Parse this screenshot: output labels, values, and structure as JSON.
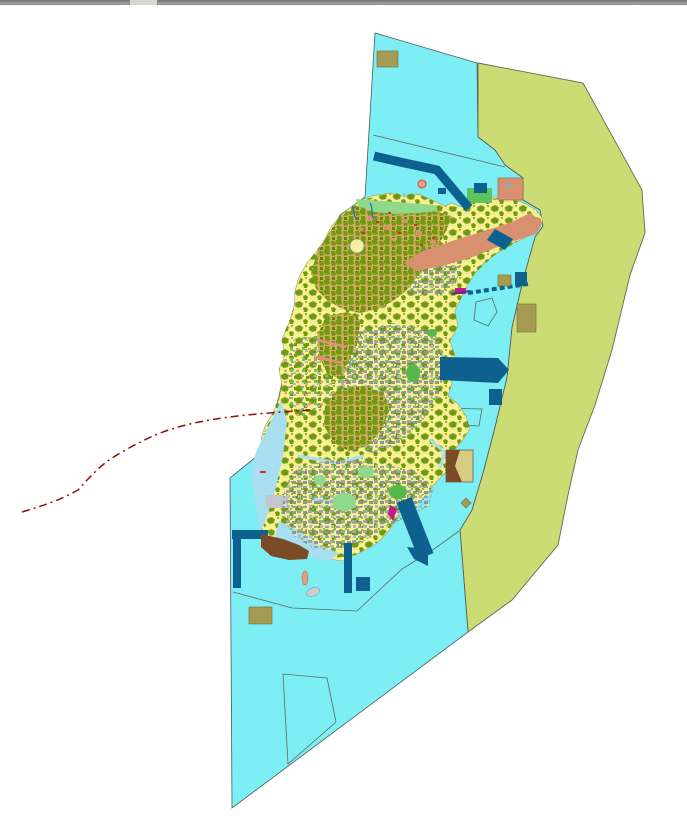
{
  "window": {
    "top_bar": {
      "color": "#8a8a8a",
      "handle_color": "#d9d6ce"
    }
  },
  "map": {
    "background": "#ffffff",
    "colors": {
      "sea": "#7deef4",
      "outer_zone": "#ccdc74",
      "island": "#f8f290",
      "forest": "#6e9a0f",
      "forest_dense_bg": "#cfa95e",
      "urban": "#a0a3ab",
      "grass": "#55b94a",
      "grass_light": "#8fd98c",
      "wetland": "#a8dff0",
      "harbour_zone": "#d79171",
      "port_works": "#0e608f",
      "special_use": "#a59b52",
      "dockland": "#7b4a26",
      "light_parcel": "#d8cc82",
      "boundary_line": "#8b1111",
      "zone_line": "#5c6a6a",
      "road": "#e98a8a",
      "river": "#2b63c9",
      "landmark_magenta": "#c2188c",
      "red_speck": "#cc3333",
      "buoy": "#e8a080"
    },
    "features": [
      {
        "id": "sea-polygon",
        "kind": "water zone"
      },
      {
        "id": "outer-zone-polygon",
        "kind": "outer marine zone"
      },
      {
        "id": "island",
        "kind": "land with land-use mosaic"
      },
      {
        "id": "port-structures",
        "kind": "piers, breakwaters, basins"
      },
      {
        "id": "special-use-squares",
        "kind": "reserved plots"
      },
      {
        "id": "harbour-belt",
        "kind": "industrial / harbour strip"
      },
      {
        "id": "dockland-area",
        "kind": "dock / quay land"
      },
      {
        "id": "boundary-dashdot-line",
        "kind": "administrative boundary"
      },
      {
        "id": "zone-outlines",
        "kind": "cadastral sub-zone outlines"
      }
    ]
  }
}
